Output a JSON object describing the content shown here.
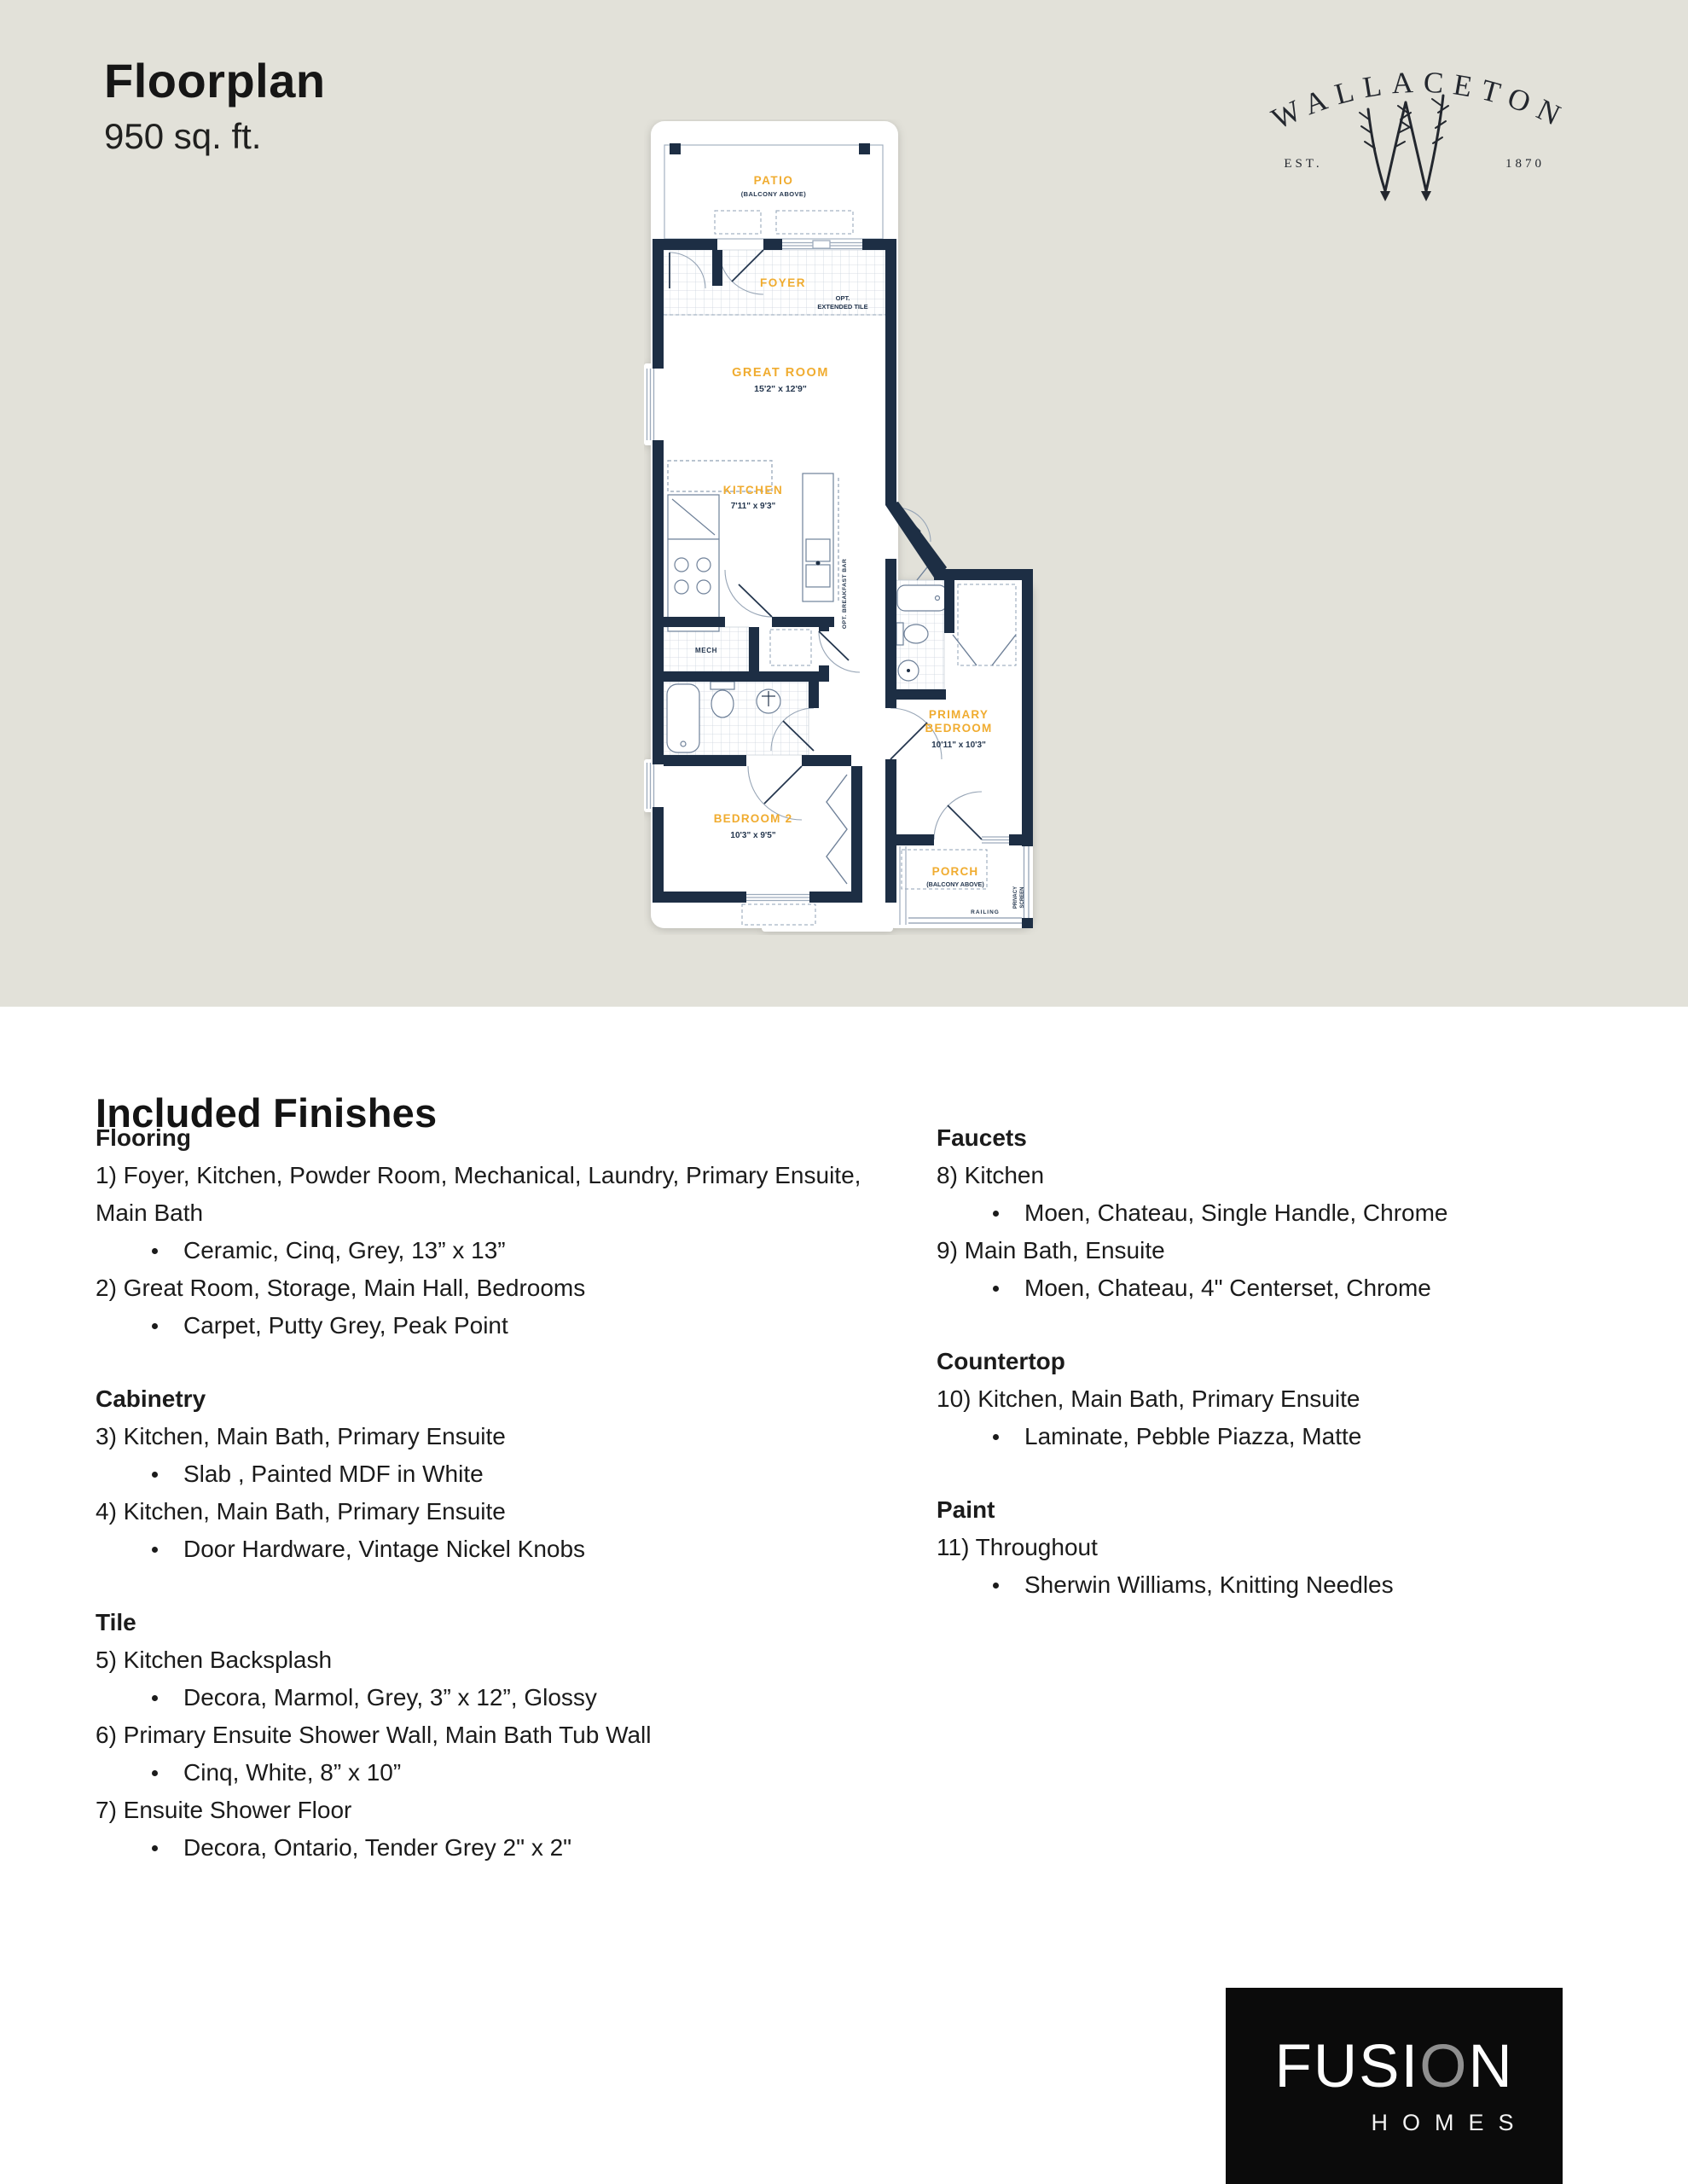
{
  "page": {
    "title": "Floorplan",
    "subtitle": "950 sq. ft."
  },
  "brand": {
    "name": "WALLACETON",
    "est": "EST.",
    "year": "1870"
  },
  "colors": {
    "accent_yellow": "#F0AC30",
    "wall_navy": "#1D2E44",
    "beige_background": "#E2E1D9",
    "fusion_logo_grey": "#8F8F8F"
  },
  "floorplan": {
    "patio": {
      "name": "PATIO",
      "note": "(BALCONY ABOVE)"
    },
    "foyer": {
      "name": "FOYER",
      "opt1": "OPT.",
      "opt2": "EXTENDED TILE"
    },
    "great_room": {
      "name": "GREAT ROOM",
      "dims": "15'2\" x 12'9\""
    },
    "kitchen": {
      "name": "KITCHEN",
      "dims": "7'11\" x 9'3\"",
      "breakfast_bar": "OPT. BREAKFAST BAR"
    },
    "mech": {
      "name": "MECH"
    },
    "primary": {
      "line1": "PRIMARY",
      "line2": "BEDROOM",
      "dims": "10'11\" x 10'3\""
    },
    "bedroom2": {
      "name": "BEDROOM 2",
      "dims": "10'3\" x 9'5\""
    },
    "porch": {
      "name": "PORCH",
      "note": "(BALCONY ABOVE)"
    },
    "privacy1": "PRIVACY",
    "privacy2": "SCREEN",
    "railing": "RAILING"
  },
  "finishes": {
    "heading": "Included Finishes",
    "left": [
      {
        "title": "Flooring",
        "items": [
          {
            "text": "1) Foyer, Kitchen, Powder Room, Mechanical, Laundry, Primary Ensuite, Main Bath"
          },
          {
            "text": "Ceramic, Cinq, Grey, 13” x 13”"
          },
          {
            "text": "2) Great Room, Storage, Main Hall, Bedrooms"
          },
          {
            "text": "Carpet, Putty Grey, Peak Point"
          }
        ]
      },
      {
        "title": "Cabinetry",
        "items": [
          {
            "text": "3) Kitchen, Main Bath, Primary Ensuite"
          },
          {
            "text": "Slab , Painted MDF in White"
          },
          {
            "text": "4) Kitchen, Main Bath, Primary Ensuite"
          },
          {
            "text": "Door Hardware, Vintage Nickel Knobs"
          }
        ]
      },
      {
        "title": "Tile",
        "items": [
          {
            "text": "5) Kitchen Backsplash"
          },
          {
            "text": "Decora, Marmol, Grey, 3” x 12”, Glossy"
          },
          {
            "text": "6) Primary Ensuite Shower Wall, Main Bath Tub Wall"
          },
          {
            "text": "Cinq, White, 8” x 10”"
          },
          {
            "text": "7) Ensuite Shower Floor"
          },
          {
            "text": "Decora, Ontario, Tender Grey 2\" x 2\""
          }
        ]
      }
    ],
    "right": [
      {
        "title": "Faucets",
        "items": [
          {
            "text": "8) Kitchen"
          },
          {
            "text": "Moen, Chateau, Single Handle, Chrome"
          },
          {
            "text": "9) Main Bath, Ensuite"
          },
          {
            "text": "Moen, Chateau, 4\" Centerset, Chrome"
          }
        ]
      },
      {
        "title": "Countertop",
        "items": [
          {
            "text": "10) Kitchen, Main Bath, Primary Ensuite"
          },
          {
            "text": "Laminate, Pebble Piazza, Matte"
          }
        ]
      },
      {
        "title": "Paint",
        "items": [
          {
            "text": "11) Throughout"
          },
          {
            "text": "Sherwin Williams, Knitting Needles"
          }
        ]
      }
    ]
  },
  "footer": {
    "part1": "FUSI",
    "accent": "O",
    "part2": "N",
    "sub": "HOMES"
  }
}
